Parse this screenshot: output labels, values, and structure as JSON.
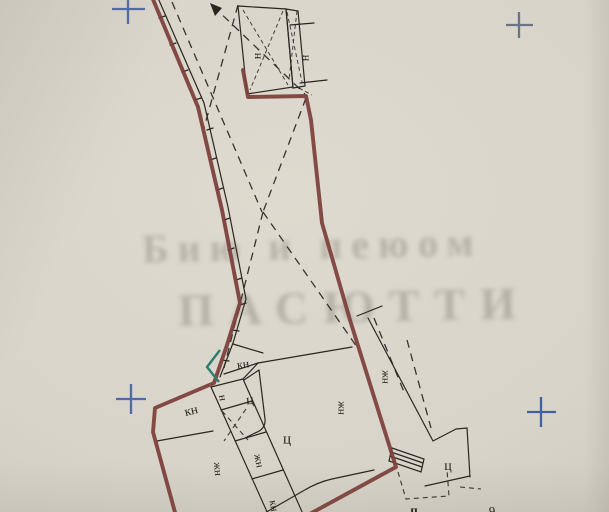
{
  "watermark": {
    "line1": "Бию и пеюом",
    "line2": "ПАСЮТТИ"
  },
  "map": {
    "labels": [
      {
        "text": "н",
        "area": "top-building-left"
      },
      {
        "text": "н",
        "area": "top-building-right"
      },
      {
        "text": "кн",
        "area": "near-teal-corner"
      },
      {
        "text": "н",
        "area": "band-top-cell"
      },
      {
        "text": "кн",
        "area": "left-parcel"
      },
      {
        "text": "ц",
        "area": "small-parcel"
      },
      {
        "text": "ц",
        "area": "central-parcel"
      },
      {
        "text": "жн",
        "area": "left-of-band"
      },
      {
        "text": "жн",
        "area": "band-middle-cell"
      },
      {
        "text": "кн",
        "area": "band-bottom-cell-clipped"
      },
      {
        "text": "жн",
        "area": "central-parcel-right"
      },
      {
        "text": "жн",
        "area": "east-strip-parcel"
      },
      {
        "text": "ц",
        "area": "south-east-parcel"
      },
      {
        "text": "п",
        "area": "bottom-edge-clipped-left"
      },
      {
        "text": "9",
        "area": "bottom-edge-clipped-right"
      }
    ],
    "markers": {
      "registration_cross": "survey registration cross",
      "cross_count": 4,
      "direction_arrow": "dashed survey line arrow"
    },
    "colors": {
      "paper": "#d8d4ca",
      "boundary_red": "#7d3f3a",
      "corner_teal": "#2d7c73",
      "cross_blue": "#44619e",
      "line_black": "#2b2620",
      "watermark_gray": "#6e6a5e"
    }
  }
}
